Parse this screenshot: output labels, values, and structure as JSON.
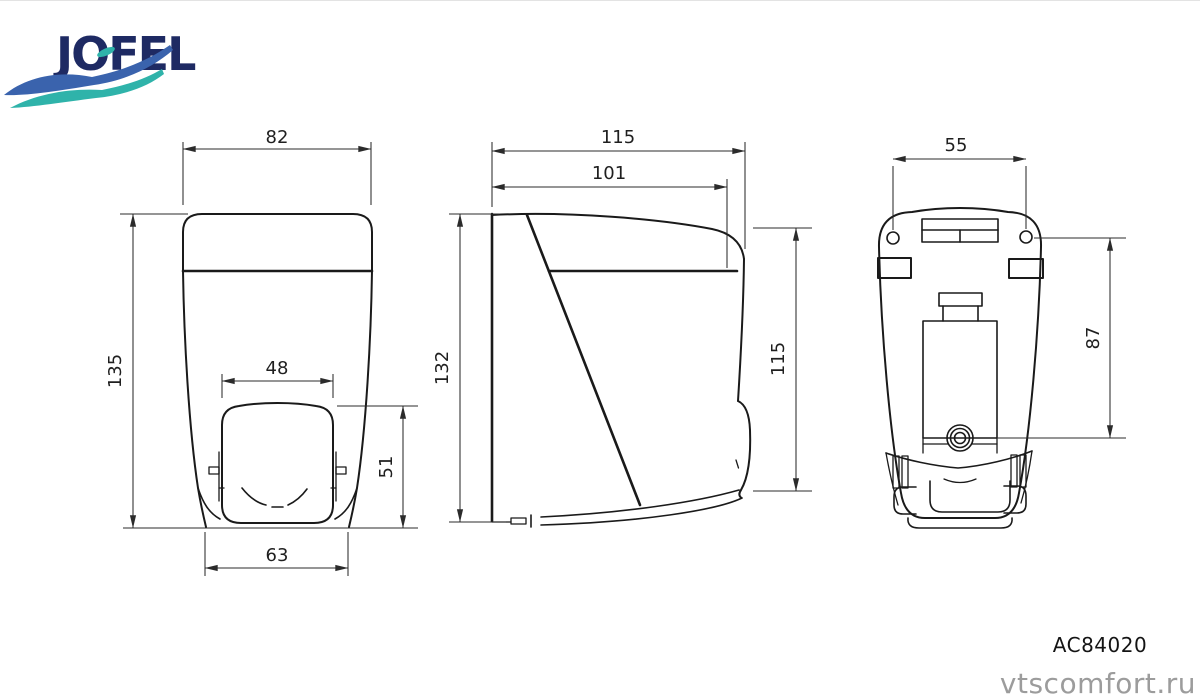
{
  "brand": {
    "name": "JOFEL"
  },
  "product": {
    "code": "AC84020"
  },
  "watermark": "vtscomfort.ru",
  "dims": {
    "front_width_top": "82",
    "front_height": "135",
    "front_button_width": "48",
    "front_button_height": "51",
    "front_width_bottom": "63",
    "side_depth_total": "115",
    "side_depth_body": "101",
    "side_height": "132",
    "side_front_height": "115",
    "back_hole_spacing": "55",
    "back_hole_to_outlet": "87"
  },
  "colors": {
    "line": "#1a1a1a",
    "dim": "#2b2b2b",
    "logo_navy": "#1e2a63",
    "logo_blue": "#3a63ad",
    "logo_teal": "#2fb3aa",
    "watermark": "#9c9c9c"
  }
}
